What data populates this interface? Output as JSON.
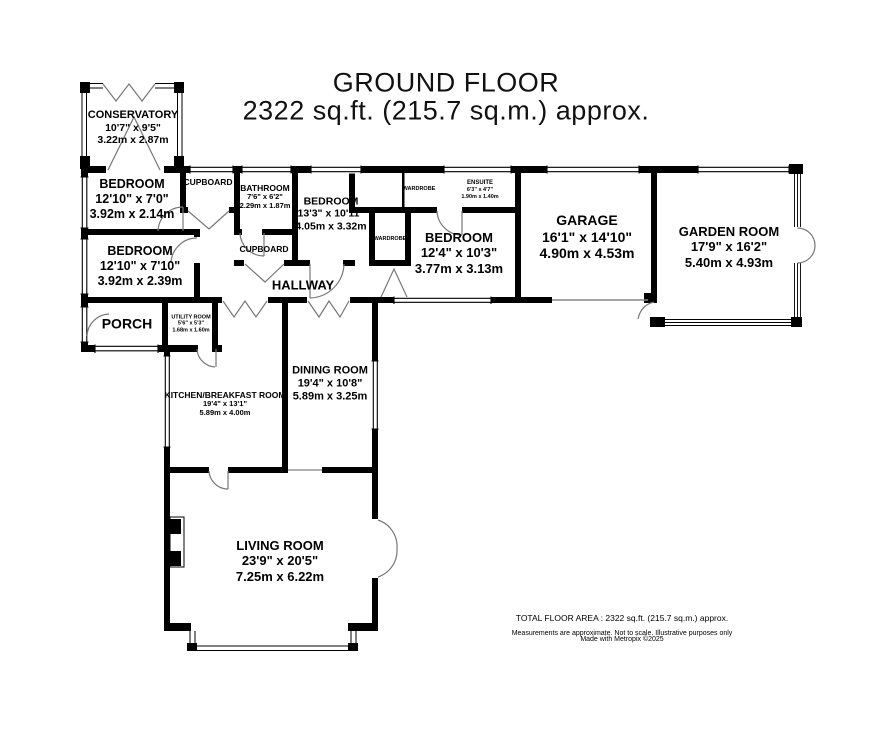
{
  "title": {
    "line1": "GROUND FLOOR",
    "line2": "2322 sq.ft. (215.7 sq.m.) approx."
  },
  "rooms": {
    "conservatory": {
      "name": "CONSERVATORY",
      "imperial": "10'7\" x 9'5\"",
      "metric": "3.22m x 2.87m"
    },
    "bedroom1": {
      "name": "BEDROOM",
      "imperial": "12'10\" x 7'0\"",
      "metric": "3.92m x 2.14m"
    },
    "cupboard1": {
      "name": "CUPBOARD"
    },
    "bathroom": {
      "name": "BATHROOM",
      "imperial": "7'6\" x 6'2\"",
      "metric": "2.29m x 1.87m"
    },
    "bedroom2": {
      "name": "BEDROOM",
      "imperial": "12'10\" x 7'10\"",
      "metric": "3.92m x 2.39m"
    },
    "cupboard2": {
      "name": "CUPBOARD"
    },
    "hallway": {
      "name": "HALLWAY"
    },
    "bedroom3": {
      "name": "BEDROOM",
      "imperial": "13'3\" x 10'11\"",
      "metric": "4.05m x 3.32m"
    },
    "wardrobe1": {
      "name": "WARDROBE"
    },
    "ensuite": {
      "name": "ENSUITE",
      "imperial": "6'3\" x 4'7\"",
      "metric": "1.90m x 1.40m"
    },
    "wardrobe2": {
      "name": "WARDROBE"
    },
    "bedroom4": {
      "name": "BEDROOM",
      "imperial": "12'4\" x 10'3\"",
      "metric": "3.77m x 3.13m"
    },
    "garage": {
      "name": "GARAGE",
      "imperial": "16'1\" x 14'10\"",
      "metric": "4.90m x 4.53m"
    },
    "garden_room": {
      "name": "GARDEN ROOM",
      "imperial": "17'9\" x 16'2\"",
      "metric": "5.40m x 4.93m"
    },
    "porch": {
      "name": "PORCH"
    },
    "utility": {
      "name": "UTILITY ROOM",
      "imperial": "5'6\" x 5'3\"",
      "metric": "1.68m x 1.60m"
    },
    "kitchen": {
      "name": "KITCHEN/BREAKFAST ROOM",
      "imperial": "19'4\" x 13'1\"",
      "metric": "5.89m x 4.00m"
    },
    "dining": {
      "name": "DINING ROOM",
      "imperial": "19'4\" x 10'8\"",
      "metric": "5.89m x 3.25m"
    },
    "living": {
      "name": "LIVING ROOM",
      "imperial": "23'9\" x 20'5\"",
      "metric": "7.25m x 6.22m"
    }
  },
  "footer": {
    "line1": "TOTAL FLOOR AREA : 2322 sq.ft. (215.7 sq.m.) approx.",
    "line2": "Measurements are approximate.  Not to scale.  Illustrative purposes only",
    "line3": "Made with Metropix ©2025"
  },
  "colors": {
    "wall": "#000000",
    "background": "#ffffff",
    "door_line": "#777777"
  }
}
